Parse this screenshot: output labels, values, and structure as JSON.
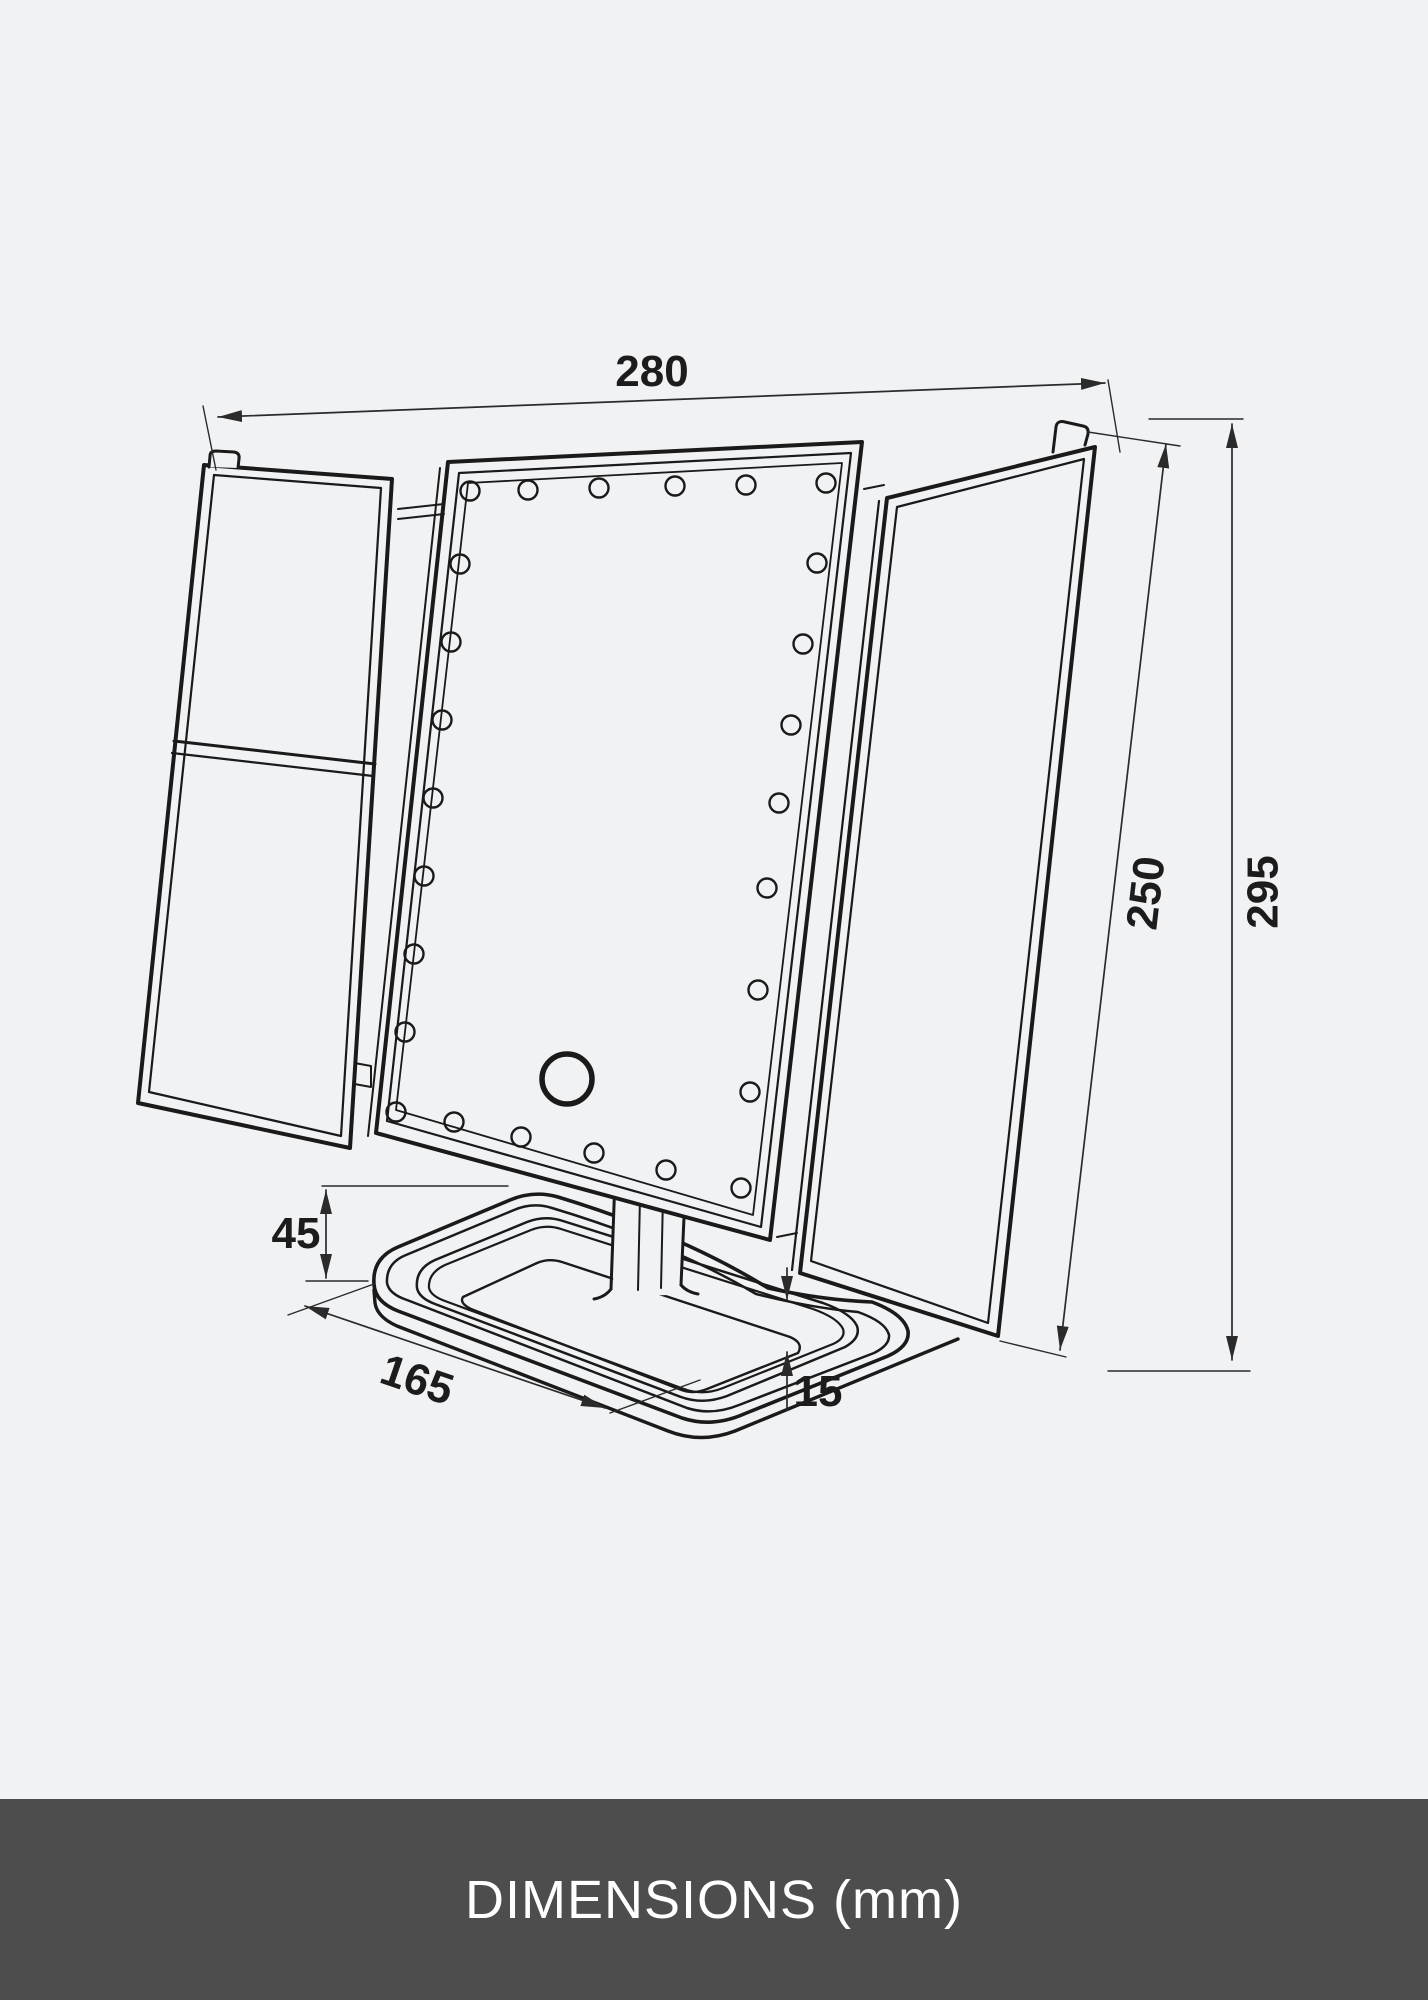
{
  "page": {
    "background_color": "#f1f2f4",
    "line_color": "#1a1a1a",
    "dimension_line_color": "#2b2b2b"
  },
  "caption_bar": {
    "label": "DIMENSIONS (mm)",
    "background_color": "#4d4d4d",
    "text_color": "#ffffff"
  },
  "diagram": {
    "subject": "trifold-led-mirror-dimension-drawing",
    "unit": "mm",
    "led_count": 26,
    "dimensions": [
      {
        "id": "overall-width",
        "value": "280"
      },
      {
        "id": "mirror-height",
        "value": "250"
      },
      {
        "id": "overall-height",
        "value": "295"
      },
      {
        "id": "stand-height",
        "value": "45"
      },
      {
        "id": "base-depth",
        "value": "165"
      },
      {
        "id": "base-thickness",
        "value": "15"
      }
    ]
  }
}
